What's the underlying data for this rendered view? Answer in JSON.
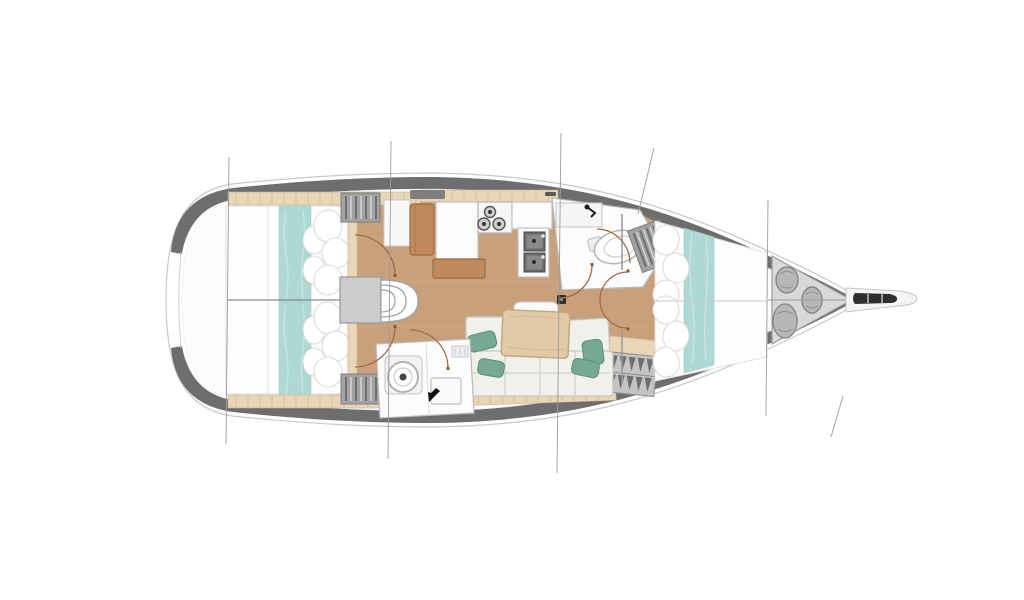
{
  "diagram": {
    "type": "yacht-interior-deck-plan",
    "orientation": "bow-right",
    "rooms": [
      {
        "name": "aft-cabin-starboard",
        "features": [
          "double-berth",
          "teal-runner",
          "pillows",
          "hanging-locker"
        ]
      },
      {
        "name": "aft-cabin-port",
        "features": [
          "double-berth",
          "teal-runner",
          "pillows",
          "hanging-locker"
        ]
      },
      {
        "name": "companionway",
        "features": [
          "engine-box",
          "curved-steps"
        ]
      },
      {
        "name": "nav-station",
        "features": [
          "seat",
          "chart-table",
          "bench"
        ]
      },
      {
        "name": "galley",
        "features": [
          "three-burner-stove",
          "double-sink",
          "counter"
        ]
      },
      {
        "name": "forward-head",
        "features": [
          "wash-basin",
          "toilet",
          "shower"
        ]
      },
      {
        "name": "aft-head",
        "features": [
          "toilet",
          "vanity-sink"
        ]
      },
      {
        "name": "saloon",
        "features": [
          "dining-table",
          "l-shaped-sofa",
          "teal-cushions",
          "mast-post",
          "shelf"
        ]
      },
      {
        "name": "forward-cabin",
        "features": [
          "v-berth",
          "teal-runner",
          "pillows",
          "hanging-lockers"
        ]
      },
      {
        "name": "anchor-locker",
        "features": [
          "sail-bags"
        ]
      },
      {
        "name": "bowsprit",
        "features": [
          "anchor-roller"
        ]
      }
    ],
    "section_lines_x": [
      228,
      390,
      560,
      767
    ]
  },
  "colors": {
    "hull": "#6e6e6e",
    "hullEdge": "#c8c8c8",
    "deck": "#fcfcfc",
    "deckLine": "#ececec",
    "floor": "#c8a17c",
    "floorStreak": "#d6b08a",
    "trim": "#e9d6b8",
    "trimTick": "#c9b190",
    "teal": "#aed8d4",
    "tealLight": "#c9e7e3",
    "tealDark": "#76a893",
    "tealDarkStroke": "#5f8f7c",
    "bed": "#fdfdfd",
    "bedStroke": "#e0e0e0",
    "pillowStroke": "#d9d9d9",
    "locker": "#a2a2a2",
    "lockerDark": "#6f6f6f",
    "lockerLight": "#d8d8d8",
    "counter": "#fbfbfb",
    "counterStroke": "#c0c0c0",
    "sinkOuter": "#6b6b6b",
    "sinkInner": "#8a8a8a",
    "dark": "#2e2e2e",
    "brown": "#c08a5e",
    "brownStroke": "#9a6a42",
    "table": "#e3caa6",
    "tableStroke": "#c6a87e",
    "cushion": "#eff1ea",
    "cushionStroke": "#c6c9c0",
    "grayBox": "#cccccc",
    "grayBoxStroke": "#999999",
    "anchorArea": "#d9d9d9",
    "anchorAreaStroke": "#9c9c9c",
    "bag": "#b7b7b7",
    "bagStroke": "#878787",
    "arc": "#a5693c",
    "sectionLine": "#9c9c9c",
    "wall": "#9a9a9a"
  }
}
